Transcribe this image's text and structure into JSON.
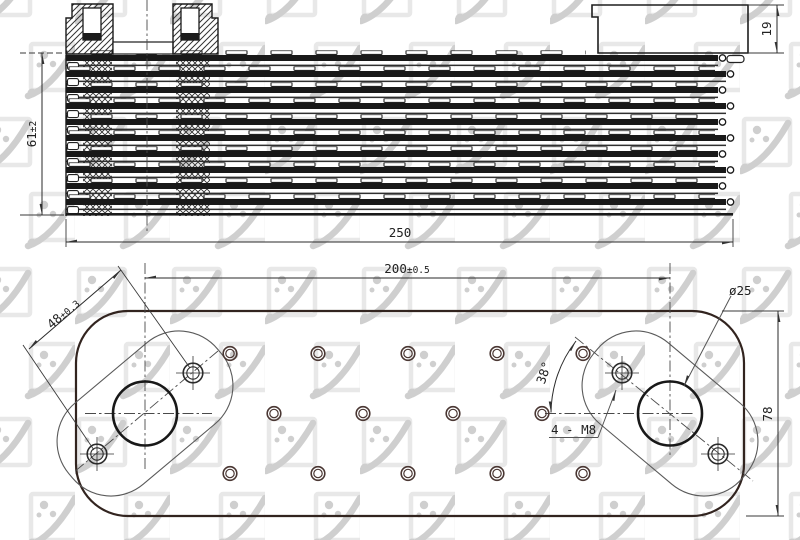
{
  "drawing": {
    "type": "oil-cooler-technical-drawing",
    "watermark": {
      "brand": "NRF"
    },
    "dims": {
      "boss_height": "19",
      "core_height": "61",
      "core_height_tol": "±2",
      "overall_length": "250",
      "port_distance": "200",
      "port_distance_tol": "±0.5",
      "bolt_spacing": "48",
      "bolt_spacing_tol": "±0.3",
      "port_diameter": "ø25",
      "bolt_angle": "38°",
      "thread_callout": "4 - M8",
      "body_width": "78"
    }
  }
}
